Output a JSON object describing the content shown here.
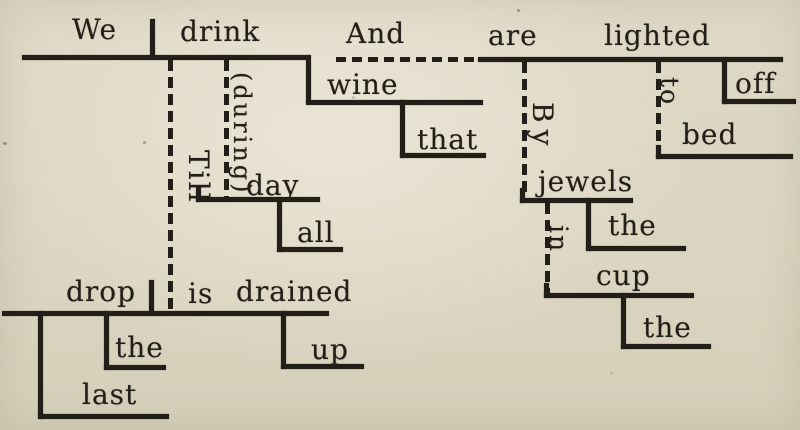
{
  "palette": {
    "paper": "#dcd6c2",
    "ink": "#221f19"
  },
  "diagram": {
    "main_clause": {
      "subject": "We",
      "verb": "drink",
      "direct_object": "wine",
      "object_modifier": "that",
      "understood_preposition": "(during)",
      "prep_object": "day",
      "prep_object_modifier": "all"
    },
    "coordinating_conjunction": "And",
    "coordinate_clause": {
      "verb_auxiliary": "are",
      "verb": "lighted",
      "particle": "off",
      "preposition_to": "to",
      "object_to": "bed",
      "preposition_by": "By",
      "object_by": "jewels",
      "jewels_modifier": "the",
      "preposition_in": "in",
      "object_in": "cup",
      "cup_modifier": "the"
    },
    "subordinating_conjunction": "Till",
    "subordinate_clause": {
      "subject": "drop",
      "subject_modifier_1": "the",
      "subject_modifier_2": "last",
      "verb_auxiliary": "is",
      "verb": "drained",
      "particle": "up"
    }
  }
}
